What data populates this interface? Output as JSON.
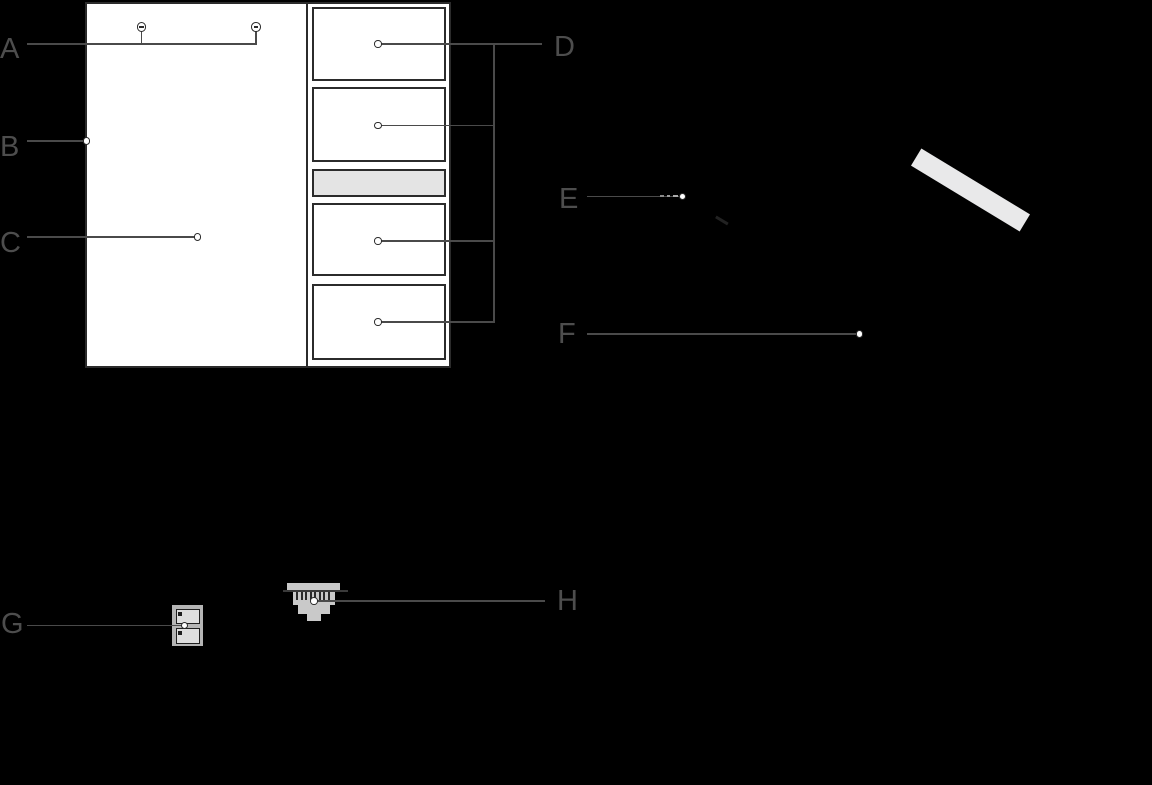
{
  "callouts": {
    "a": {
      "label": "A"
    },
    "b": {
      "label": "B"
    },
    "c": {
      "label": "C"
    },
    "d": {
      "label": "D"
    },
    "e": {
      "label": "E"
    },
    "f": {
      "label": "F"
    },
    "g": {
      "label": "G"
    },
    "h": {
      "label": "H"
    }
  },
  "colors": {
    "background": "#000000",
    "panel_fill": "#ffffff",
    "outline": "#2b2b2b",
    "leader_line": "#4a4a4a",
    "label_text": "#4d4d4d",
    "blank_slot_fill": "#e4e4e4",
    "strip_fill": "#e9e9ea",
    "plug_gray": "#c9c9c9",
    "terminal_gray": "#b5b5b5",
    "terminal_slot_fill": "#dedede",
    "contact_dark": "#1f1f1f"
  },
  "icons": {
    "screws": "slotted-screw-icon",
    "modules": "module-slot",
    "strip": "label-strip",
    "terminal": "terminal-block-icon",
    "plug": "rj45-plug-icon"
  }
}
